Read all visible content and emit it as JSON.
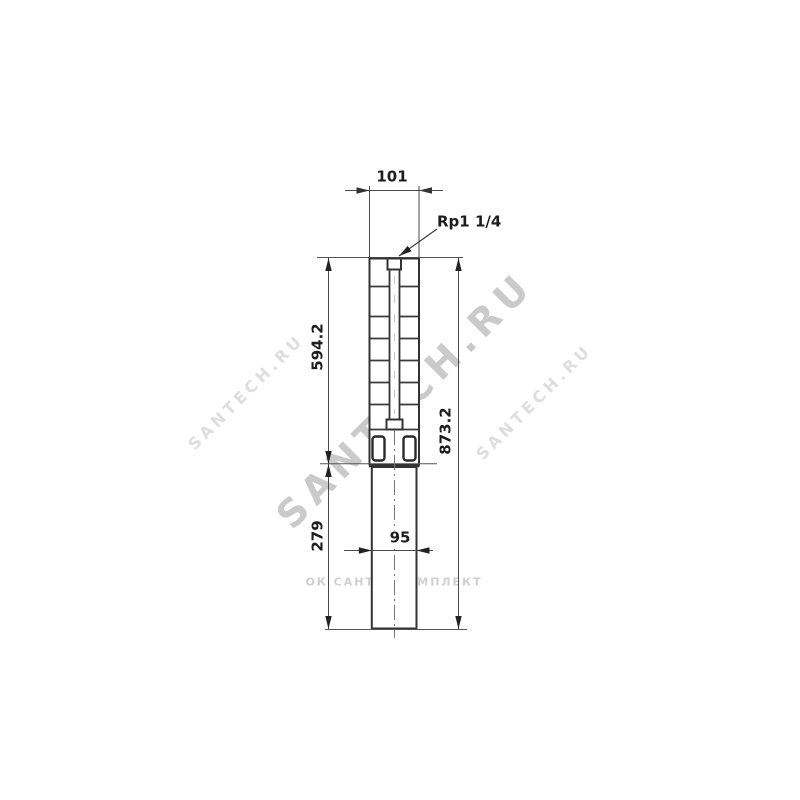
{
  "drawing": {
    "type": "submersible-pump-dimension-drawing",
    "labels": {
      "top_width_mm": "101",
      "connection_thread": "Rp1 1/4",
      "pump_section_length_mm": "594.2",
      "motor_section_length_mm": "279",
      "total_length_mm": "873.2",
      "motor_width_mm": "95"
    },
    "watermarks": {
      "diagonal_main": "SANTECH.RU",
      "diagonal_small_left": "SANTECH.RU",
      "diagonal_small_right": "SANTECH.RU",
      "horizontal": "ОК САНТЕХКОМПЛЕКТ"
    },
    "colors": {
      "outline": "#333333",
      "dimension_line": "#4a4a4a",
      "text": "#1d1d1d",
      "centerline": "#777777",
      "watermark": "#9e9e9e",
      "background": "#ffffff"
    }
  }
}
